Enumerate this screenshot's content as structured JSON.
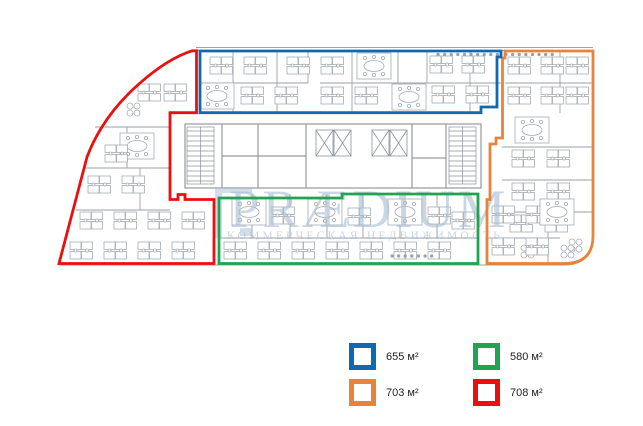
{
  "watermark": {
    "title": "PRÆDIUM",
    "subtitle": "КОММЕРЧЕСКАЯ НЕДВИЖИМОСТЬ"
  },
  "legend": {
    "items": [
      {
        "name": "blue",
        "label": "655 м²",
        "color": "#0d6ab2"
      },
      {
        "name": "green",
        "label": "580 м²",
        "color": "#21a351"
      },
      {
        "name": "orange",
        "label": "703 м²",
        "color": "#e8833c"
      },
      {
        "name": "red",
        "label": "708 м²",
        "color": "#ea1010"
      }
    ]
  }
}
